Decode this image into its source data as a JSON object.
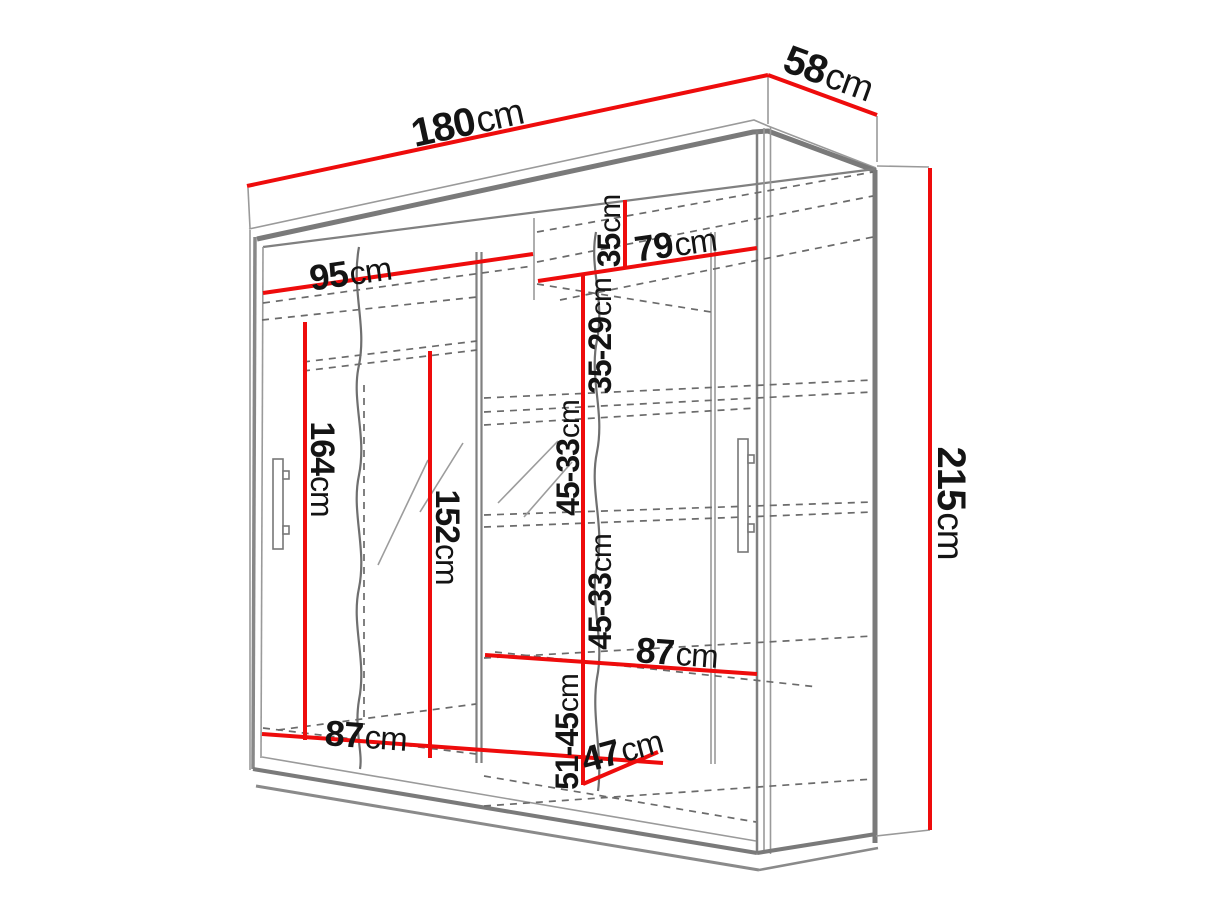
{
  "diagram": {
    "type": "wardrobe-dimension-drawing",
    "colors": {
      "dimension": "#ee0c0c",
      "structure": "#7a7a7a",
      "text": "#141414",
      "background": "#ffffff"
    },
    "dims": {
      "total_width": {
        "num": "180",
        "unit": "cm"
      },
      "total_depth": {
        "num": "58",
        "unit": "cm"
      },
      "total_height": {
        "num": "215",
        "unit": "cm"
      },
      "left_section_top_width": {
        "num": "95",
        "unit": "cm"
      },
      "right_section_top_width": {
        "num": "79",
        "unit": "cm"
      },
      "top_shelf_gap": {
        "num": "35",
        "unit": "cm"
      },
      "upper_shelf_gap": {
        "num": "35-29",
        "unit": "cm"
      },
      "middle_shelf_gap_upper": {
        "num": "45-33",
        "unit": "cm"
      },
      "middle_shelf_gap_lower": {
        "num": "45-33",
        "unit": "cm"
      },
      "bottom_shelf_gap": {
        "num": "51-45",
        "unit": "cm"
      },
      "left_section_height": {
        "num": "164",
        "unit": "cm"
      },
      "mirror_panel_height": {
        "num": "152",
        "unit": "cm"
      },
      "left_section_bottom_width": {
        "num": "87",
        "unit": "cm"
      },
      "right_shelf_width": {
        "num": "87",
        "unit": "cm"
      },
      "bottom_compartment_depth": {
        "num": "47",
        "unit": "cm"
      }
    }
  }
}
